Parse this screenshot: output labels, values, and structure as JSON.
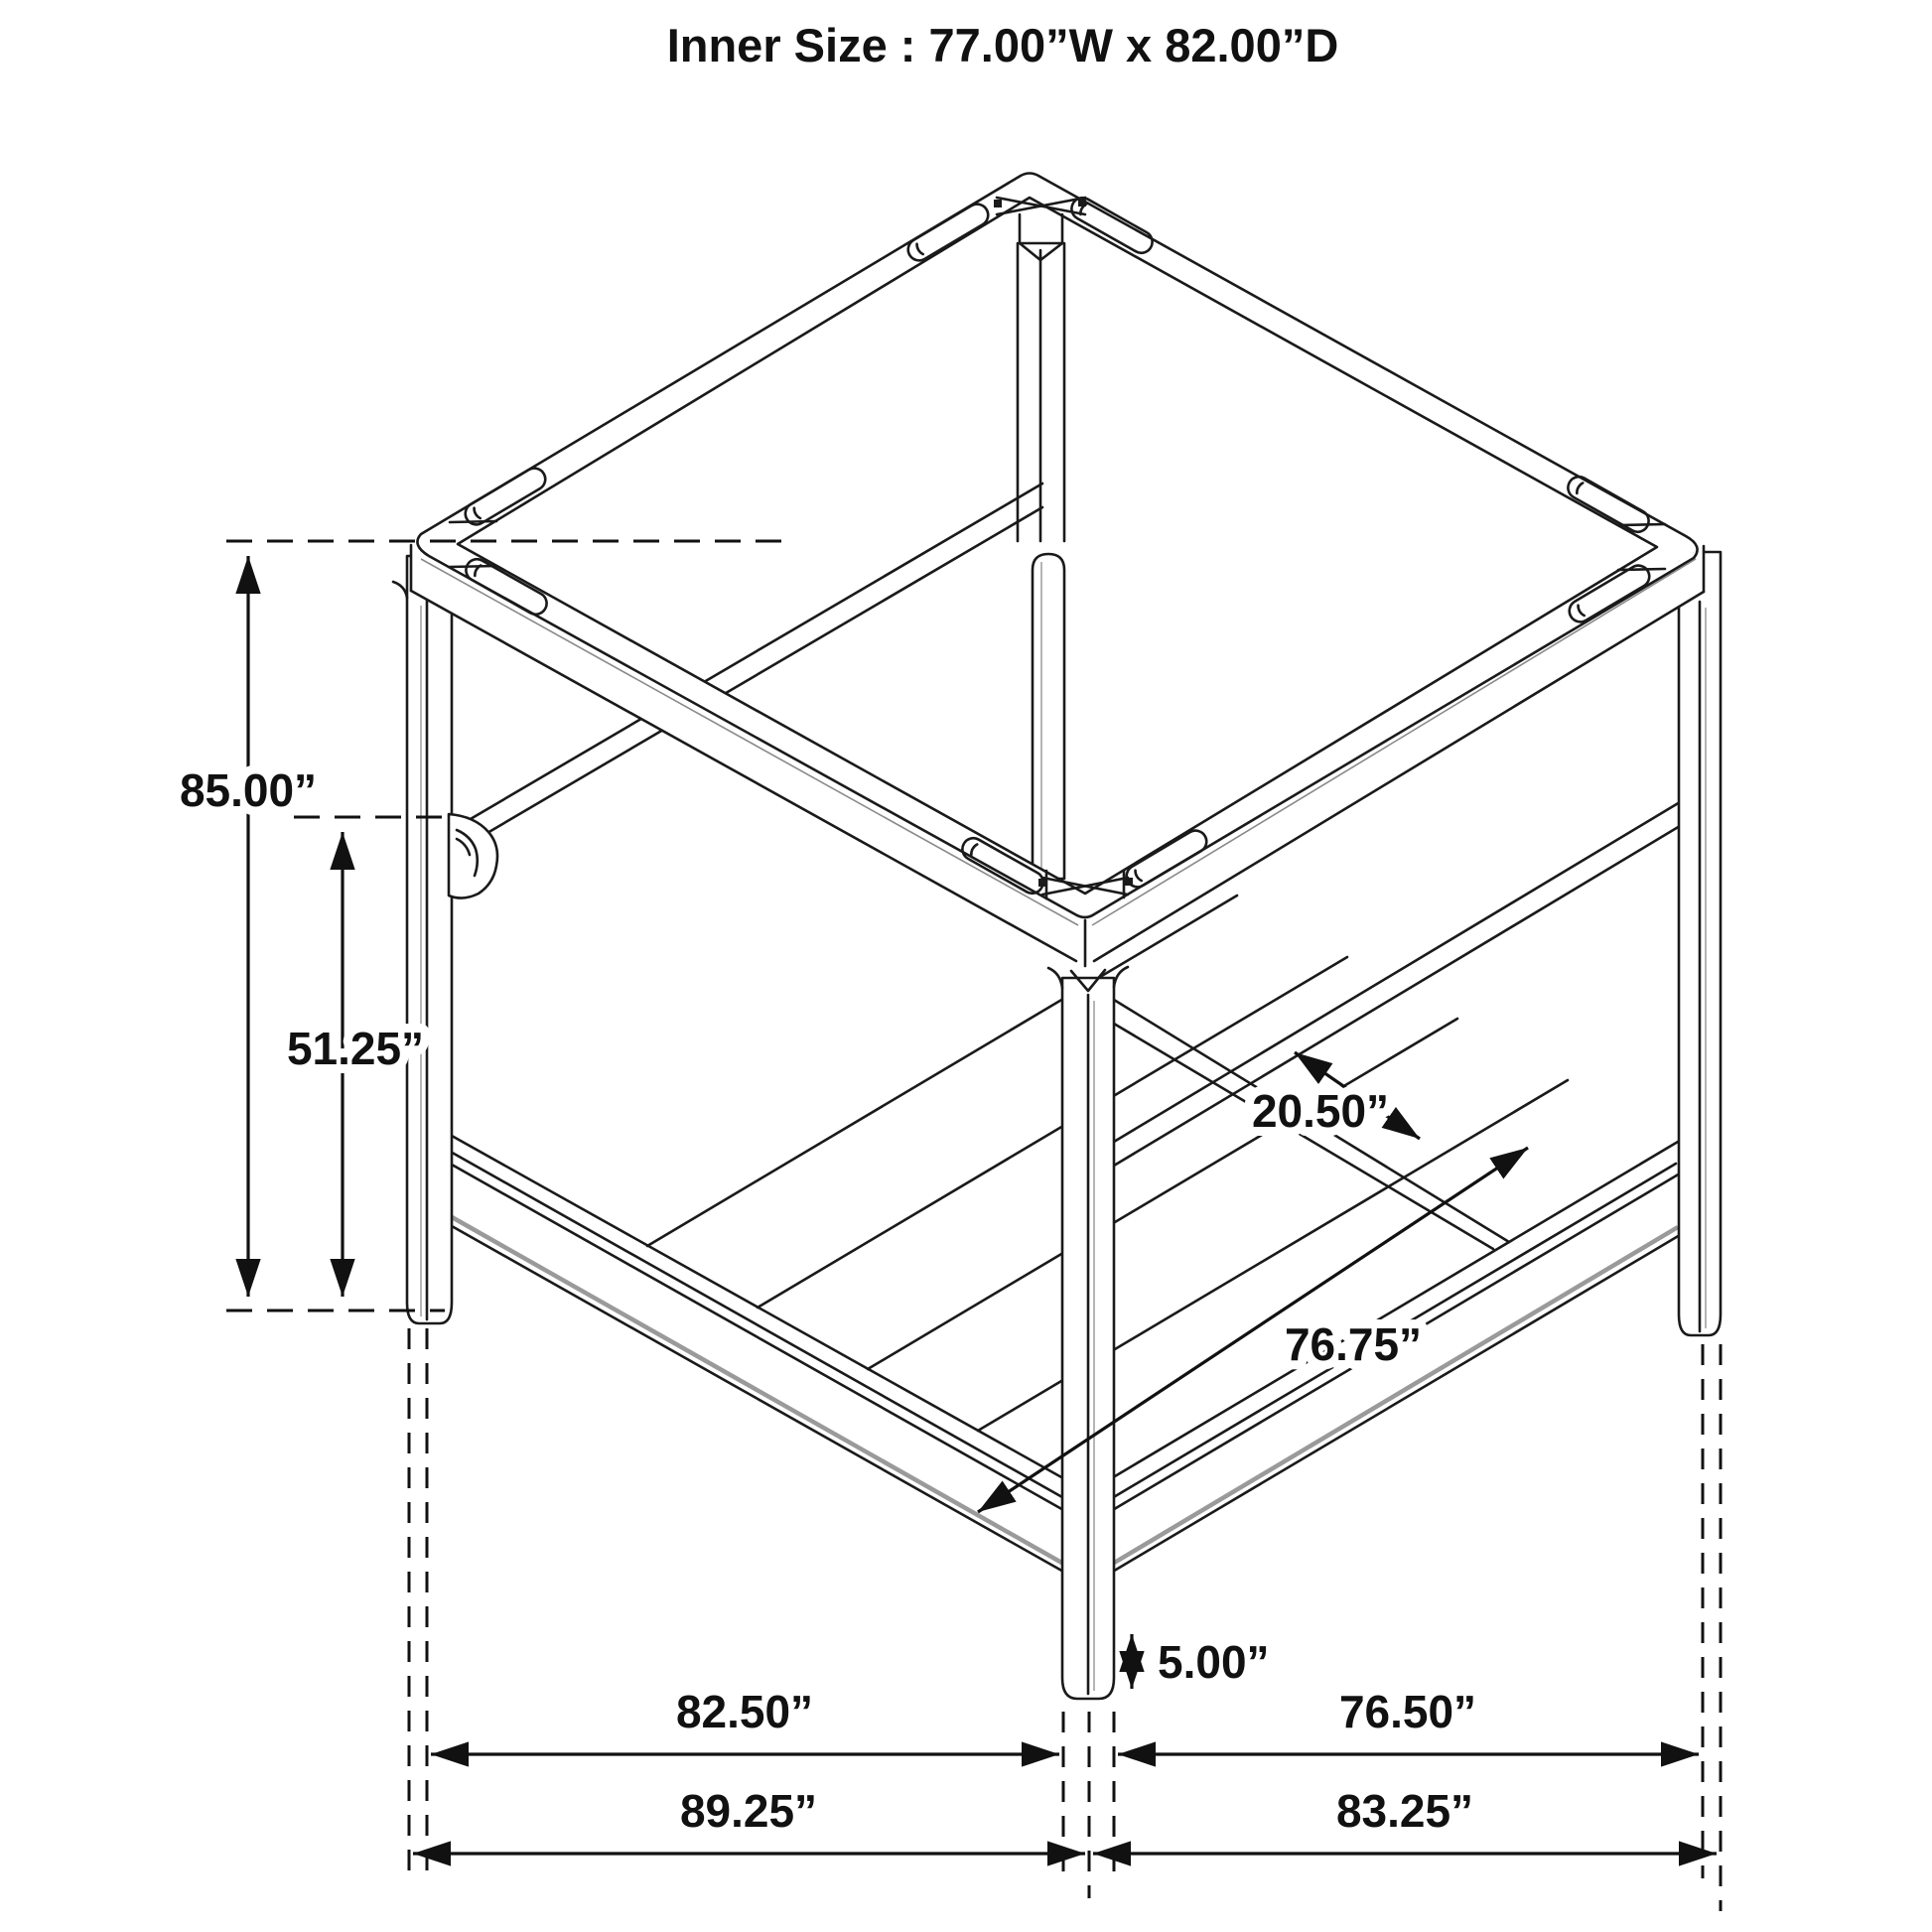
{
  "title": "Inner Size : 77.00”W x 82.00”D",
  "dimensions": {
    "overall_height": "85.00”",
    "headboard_rail_height": "51.25”",
    "rail_gap": "20.50”",
    "slat_length": "76.75”",
    "floor_clearance": "5.00”",
    "depth_inner": "82.50”",
    "depth_outer": "89.25”",
    "width_inner": "76.50”",
    "width_outer": "83.25”"
  },
  "colors": {
    "line": "#1a1a1a",
    "dimension": "#111111",
    "accent": "#999999",
    "background": "#ffffff"
  }
}
